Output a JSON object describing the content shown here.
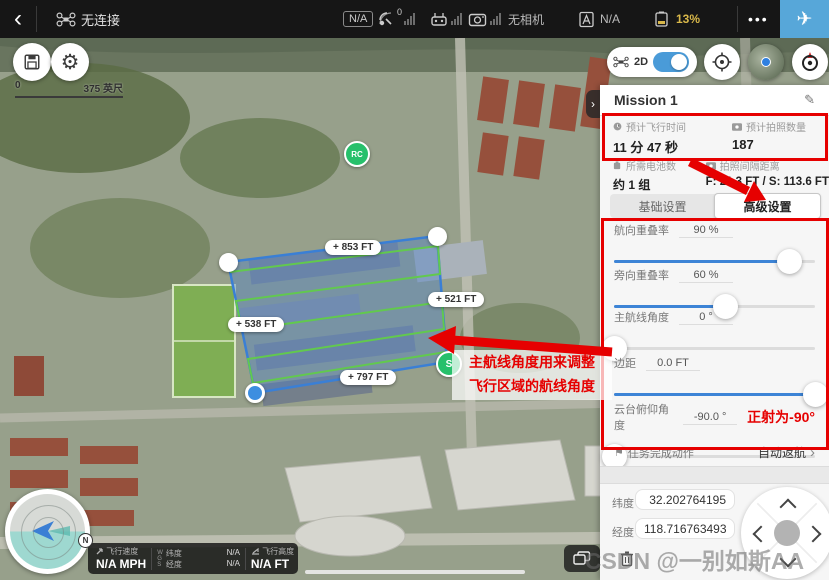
{
  "colors": {
    "accent_blue": "#3d84d6",
    "annotation_red": "#e60000",
    "battery_yellow": "#d9b84a",
    "polygon_blue": "#3a7fd5",
    "route_green": "#62c94e",
    "marker_green": "#27c06b",
    "takeoff_blue": "#57a7d9"
  },
  "top_bar": {
    "back": "‹",
    "connection_status": "无连接",
    "na_badge": "N/A",
    "gps_count": "0",
    "camera_status": "无相机",
    "flight_mode_value": "N/A",
    "battery_percent": "13%",
    "more": "•••",
    "takeoff": "✈"
  },
  "map_controls": {
    "mode_label": "2D",
    "scale_start": "0",
    "scale_end": "375 英尺"
  },
  "map": {
    "rc_marker": "RC",
    "start_marker": "S",
    "compass_north": "N",
    "edge_labels": {
      "top": "+ 853 FT",
      "right": "+ 521 FT",
      "left": "+ 538 FT",
      "bottom": "+ 797 FT"
    },
    "annotation": {
      "line1": "主航线角度用来调整",
      "line2": "飞行区域的航线角度"
    }
  },
  "telemetry": {
    "speed_label": "飞行速度",
    "speed_value": "N/A MPH",
    "datum": "WGS",
    "lat_label": "纬度",
    "lat_value": "N/A",
    "lng_label": "经度",
    "lng_value": "N/A",
    "alt_label": "飞行高度",
    "alt_value": "N/A FT"
  },
  "panel": {
    "title": "Mission 1",
    "collapse": "›",
    "edit_icon": "✎",
    "stats": [
      {
        "label": "预计飞行时间",
        "value": "11 分 47 秒"
      },
      {
        "label": "预计拍照数量",
        "value": "187"
      },
      {
        "label": "所需电池数",
        "value": "约 1 组"
      },
      {
        "label": "拍照间隔距离",
        "value": "F: 21.3 FT / S: 113.6 FT"
      }
    ],
    "tabs": {
      "basic": "基础设置",
      "advanced": "高级设置"
    },
    "sliders": [
      {
        "label": "航向重叠率",
        "value": "90 %",
        "percent": 87
      },
      {
        "label": "旁向重叠率",
        "value": "60 %",
        "percent": 55
      },
      {
        "label": "主航线角度",
        "value": "0 °",
        "percent": 0
      },
      {
        "label": "边距",
        "value": "0.0 FT",
        "percent": 100
      },
      {
        "label": "云台俯仰角度",
        "value": "-90.0 °",
        "percent": 0,
        "note": "正射为-90°"
      }
    ],
    "finish_action": {
      "label": "任务完成动作",
      "value": "自动返航",
      "chevron": "›"
    },
    "coordinates": {
      "lat_label": "纬度",
      "lat_value": "32.202764195",
      "lng_label": "经度",
      "lng_value": "118.716763493"
    }
  },
  "watermark": "CSDN @一别如斯AA"
}
